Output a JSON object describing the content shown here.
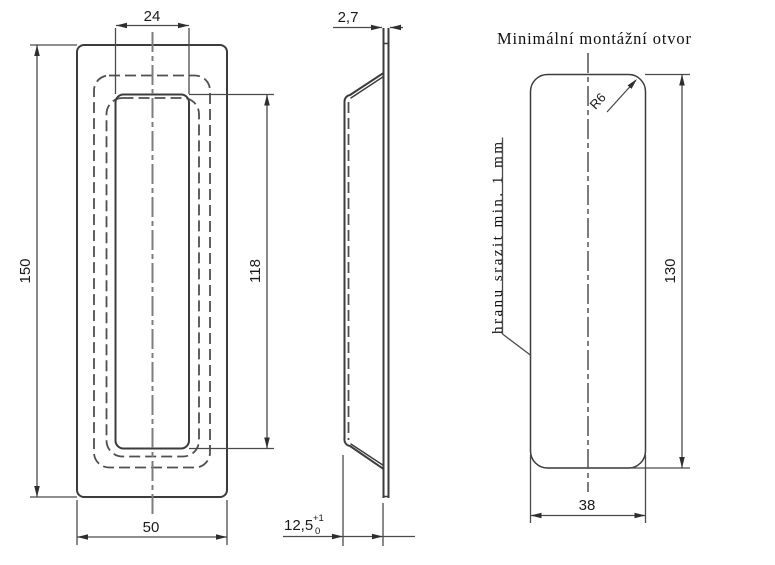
{
  "drawing": {
    "title": "Minimální montážní otvor",
    "note": "hranu srazit min. 1 mm",
    "front_view": {
      "outer_width": "50",
      "outer_height": "150",
      "inner_width": "24",
      "inner_height": "118"
    },
    "side_view": {
      "flange_thickness": "2,7",
      "depth": "12,5",
      "depth_tol_upper": "+1",
      "depth_tol_lower": "0"
    },
    "mounting_view": {
      "hole_width": "38",
      "hole_height": "130",
      "corner_radius": "R6"
    },
    "colors": {
      "object_line": "#3c3c3c",
      "hidden_line": "#4f4f4f",
      "centerline": "#7d7d7d",
      "dimension_line": "#4a4a4a",
      "background": "#ffffff"
    }
  }
}
